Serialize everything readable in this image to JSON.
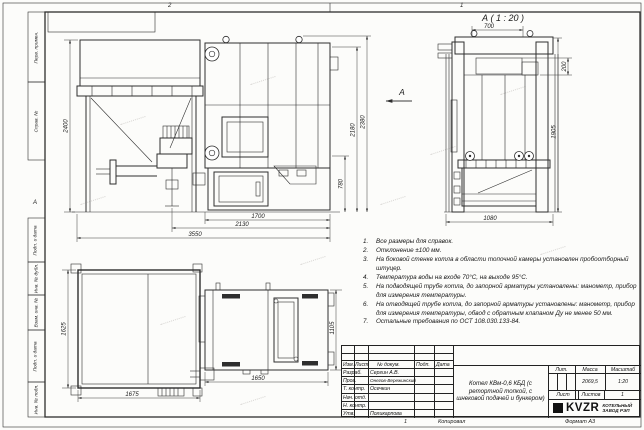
{
  "sheet": {
    "zones": {
      "top_left": "2",
      "top_right": "1",
      "left": "А"
    },
    "footer": {
      "num": "1",
      "copied": "Копировал",
      "format": "Формат А3"
    },
    "margin_labels": {
      "perv": "Перв. примен.",
      "sprav": "Справ. №",
      "podp1": "Подп. и дата",
      "inv_dubl": "Инв. № дубл.",
      "vzam": "Взам. инв. №",
      "podp2": "Подп. и дата",
      "inv_podl": "Инв. № подл."
    }
  },
  "drawing": {
    "view_label": "А ( 1 : 20 )",
    "view_arrow": "А",
    "dims": {
      "d2400": "2400",
      "d780": "780",
      "d2180": "2180",
      "d2380": "2380",
      "d1700": "1700",
      "d2130": "2130",
      "d3550": "3550",
      "d700": "700",
      "d200": "200",
      "d1905": "1905",
      "d1080": "1080",
      "d1625": "1625",
      "d1675": "1675",
      "d1650": "1650",
      "d1105": "1105"
    }
  },
  "notes": {
    "items": [
      {
        "n": "1.",
        "t": "Все размеры для справок."
      },
      {
        "n": "2.",
        "t": "Отклонение ±100 мм."
      },
      {
        "n": "3.",
        "t": "На боковой стенке котла в области топочной камеры установлен пробоотборный штуцер."
      },
      {
        "n": "4.",
        "t": "Температура воды на входе 70°С, на выходе 95°С."
      },
      {
        "n": "5.",
        "t": "На подводящей трубе котла, до запорной арматуры установлены: манометр, прибор для измерения температуры."
      },
      {
        "n": "6.",
        "t": "На отводящей трубе котла, до запорной арматуры установлены: манометр, прибор для измерения температуры, обвод с обратным клапаном Ду не менее 50 мм."
      },
      {
        "n": "7.",
        "t": "Остальные требования по ОСТ 108.030.133-84."
      }
    ]
  },
  "title_block": {
    "header_cols": {
      "izm": "Изм.",
      "list": "Лист",
      "doc": "№ докум.",
      "podp": "Подп.",
      "data": "Дата"
    },
    "rows": [
      {
        "role": "Разраб.",
        "name": "Сергин А.В."
      },
      {
        "role": "Пров.",
        "name": "Онегов-Вережинский"
      },
      {
        "role": "Т. контр.",
        "name": "Осечкин"
      },
      {
        "role": "Нач. отд.",
        "name": ""
      },
      {
        "role": "Н. контр.",
        "name": ""
      },
      {
        "role": "Утв.",
        "name": "Поликарпова"
      }
    ],
    "title": "Котел КВм-0,6 КБД (с ретортной топкой, с шнековой подачей и бункером)",
    "lit_label": "Лит.",
    "mass_label": "Масса",
    "scale_label": "Масштаб",
    "mass": "2069,5",
    "scale": "1:20",
    "sheet_label": "Лист",
    "sheets_label": "Листов",
    "sheets_value": "1",
    "company": {
      "logo": "KVZR",
      "name1": "КОТЕЛЬНЫЙ",
      "name2": "ЗАВОД РЭП"
    }
  }
}
